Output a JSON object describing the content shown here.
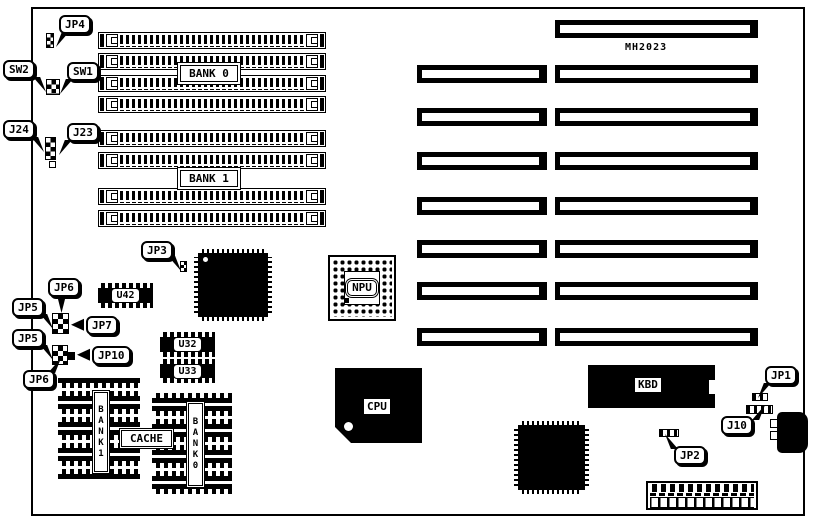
{
  "board": {
    "model": "MH2023",
    "colors": {
      "ink": "#000000",
      "paper": "#ffffff"
    }
  },
  "memory": {
    "bank0_label": "BANK 0",
    "bank1_label": "BANK 1"
  },
  "cache": {
    "label": "CACHE",
    "bank1_label": "BANK1",
    "bank0_label": "BANK0"
  },
  "chips": {
    "u42": "U42",
    "u32": "U32",
    "u33": "U33",
    "npu": "NPU",
    "cpu": "CPU",
    "kbd": "KBD"
  },
  "callouts": {
    "jp1": "JP1",
    "jp2": "JP2",
    "jp3": "JP3",
    "jp4": "JP4",
    "jp5": "JP5",
    "jp6": "JP6",
    "jp7": "JP7",
    "jp10": "JP10",
    "j10": "J10",
    "j23": "J23",
    "j24": "J24",
    "sw1": "SW1",
    "sw2": "SW2"
  }
}
